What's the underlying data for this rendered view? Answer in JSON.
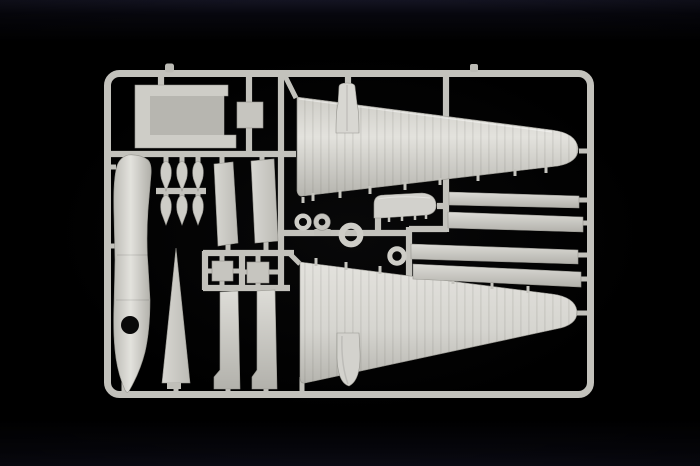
{
  "meta": {
    "kind": "photograph",
    "width_px": 700,
    "height_px": 466
  },
  "scene": {
    "description": "Photograph of an unassembled injection-molded model aircraft sprue (runner) of light gray polystyrene parts on a black backdrop",
    "plastic": "unpainted light gray polystyrene",
    "backdrop": "black studio background",
    "text_visible": "none"
  },
  "colors": {
    "background": "#000000",
    "backdrop_top_tint": "#141422",
    "plastic_light": "#e3e2dd",
    "plastic_mid": "#cecdc7",
    "plastic_mid2": "#c6c5bf",
    "plastic_dark": "#b5b4ae",
    "runner_gray": "#c3c2bc",
    "web_gray": "#b7b6b0",
    "edge_shadow": "#96958f",
    "hole_black": "#090909"
  },
  "parts": [
    {
      "id": "sprue-frame",
      "label": "rectangular runner frame with rounded corners"
    },
    {
      "id": "upper-wing-half",
      "label": "large tapered wing half, root at left, tip at right"
    },
    {
      "id": "wing-pylon",
      "label": "small pylon standing on upper wing root"
    },
    {
      "id": "lower-wing-half",
      "label": "large tapered wing half, mirrored below"
    },
    {
      "id": "underwing-pod",
      "label": "small rounded pod hanging under lower wing root"
    },
    {
      "id": "fuselage-half",
      "label": "long hull half with round opening near bottom"
    },
    {
      "id": "center-section",
      "label": "flat I-beam shaped center-section part",
      "count": 1
    },
    {
      "id": "small-panel",
      "label": "small square panel part",
      "count": 1
    },
    {
      "id": "bomb",
      "label": "teardrop bomb/float part",
      "count": 6
    },
    {
      "id": "flap-panel",
      "label": "tapered flat flap panel",
      "count": 2
    },
    {
      "id": "hatch-square",
      "label": "small square hatch part",
      "count": 2
    },
    {
      "id": "fin-triangle",
      "label": "narrow triangular fin/mast"
    },
    {
      "id": "stepped-strut",
      "label": "vertical strut with stepped foot",
      "count": 2
    },
    {
      "id": "cowl-ring-small",
      "label": "small open ring"
    },
    {
      "id": "wheel",
      "label": "small wheel with dark hub"
    },
    {
      "id": "cowl-ring-large",
      "label": "large open ring"
    },
    {
      "id": "cowl-ring-medium",
      "label": "medium open ring"
    },
    {
      "id": "canopy-fairing",
      "label": "rounded fairing part with gate ticks"
    },
    {
      "id": "spar-strip",
      "label": "long narrow spar strip",
      "count": 4
    }
  ]
}
